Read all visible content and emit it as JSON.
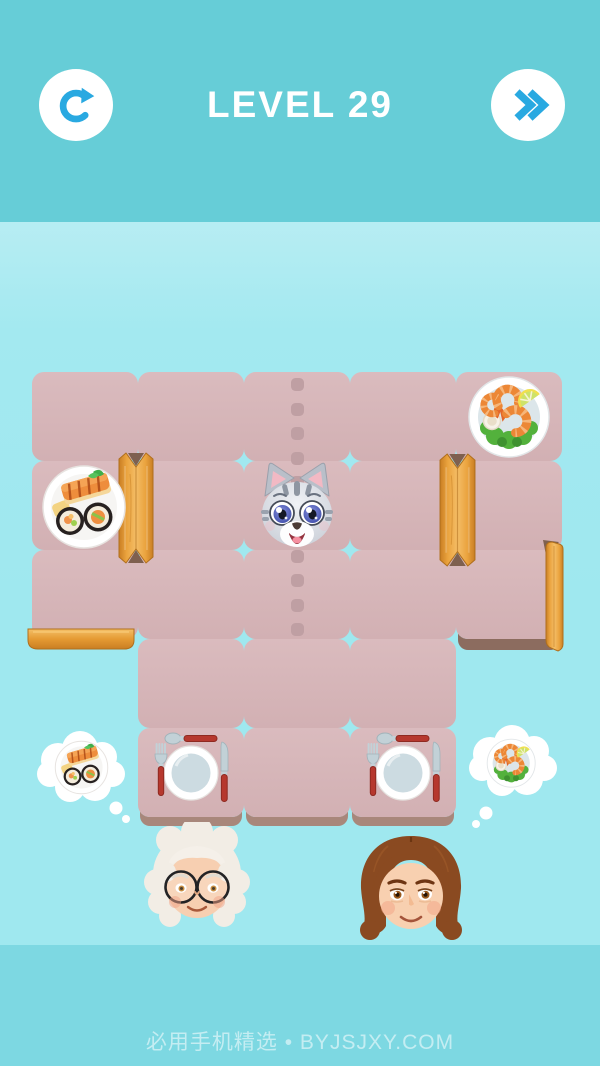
{
  "header": {
    "title": "LEVEL 29",
    "buttons": [
      {
        "name": "restart",
        "icon": "restart-icon"
      },
      {
        "name": "skip-level",
        "icon": "skip-forward-icon"
      }
    ]
  },
  "colors": {
    "header_bg": "#66cdd7",
    "background": "#9fe8ef",
    "background_bottom_band": "#7dd8e2",
    "tile_pink": "#d6b5b8",
    "path_dot": "#bf9fa3",
    "wood": "#eaa33e",
    "accent_blue": "#29a9e1",
    "utensil_handle_red": "#b6382e",
    "plate_inner": "#ccdbe1"
  },
  "board": {
    "grid": {
      "columns": 5,
      "rows": 5,
      "cell_width": 106,
      "cell_height": 89,
      "origin_x": 32,
      "origin_y": 372
    },
    "tiles": [
      {
        "row": 1,
        "col": 1
      },
      {
        "row": 1,
        "col": 2
      },
      {
        "row": 1,
        "col": 3
      },
      {
        "row": 1,
        "col": 4
      },
      {
        "row": 1,
        "col": 5
      },
      {
        "row": 2,
        "col": 1
      },
      {
        "row": 2,
        "col": 2
      },
      {
        "row": 2,
        "col": 3
      },
      {
        "row": 2,
        "col": 4
      },
      {
        "row": 2,
        "col": 5
      },
      {
        "row": 3,
        "col": 1
      },
      {
        "row": 3,
        "col": 2
      },
      {
        "row": 3,
        "col": 3
      },
      {
        "row": 3,
        "col": 4
      },
      {
        "row": 3,
        "col": 5
      },
      {
        "row": 4,
        "col": 2
      },
      {
        "row": 4,
        "col": 3
      },
      {
        "row": 4,
        "col": 4
      },
      {
        "row": 5,
        "col": 2
      },
      {
        "row": 5,
        "col": 3
      },
      {
        "row": 5,
        "col": 4
      }
    ],
    "bottom_shadow_tiles": [
      "5,2",
      "5,3",
      "5,4"
    ],
    "dark_shadow_tiles": [
      "3,5"
    ],
    "dotted_path": {
      "column": 3,
      "count": 11,
      "size": 13,
      "spacing": 24.5,
      "x_center": 297,
      "first_y": 378
    },
    "pieces": [
      {
        "type": "shrimp-plate",
        "cell": "1,5"
      },
      {
        "type": "sushi-plate",
        "cell": "2,1"
      },
      {
        "type": "cat",
        "cell": "2,3"
      }
    ],
    "gates": [
      {
        "type": "wood-gate-vertical",
        "between": "cells 2,1 and 2,2"
      },
      {
        "type": "wood-gate-vertical",
        "between": "cells 2,4 and 2,5"
      },
      {
        "type": "wood-gate-vertical",
        "position": "right edge of cell 3,5"
      },
      {
        "type": "wood-bar-horizontal",
        "position": "bottom edge of cell 3,1"
      }
    ],
    "tables": [
      {
        "cell": "5,2",
        "items": [
          "spoon",
          "plate",
          "fork",
          "knife"
        ]
      },
      {
        "cell": "5,4",
        "items": [
          "spoon",
          "plate",
          "fork",
          "knife"
        ]
      }
    ]
  },
  "characters": [
    {
      "id": "grandma",
      "description": "elderly woman, white curly hair, round glasses",
      "craving": "sushi-plate"
    },
    {
      "id": "woman",
      "description": "woman with brown wavy hair",
      "craving": "shrimp-plate"
    }
  ],
  "footer": {
    "watermark": "必用手机精选 • BYJSJXY.COM"
  }
}
